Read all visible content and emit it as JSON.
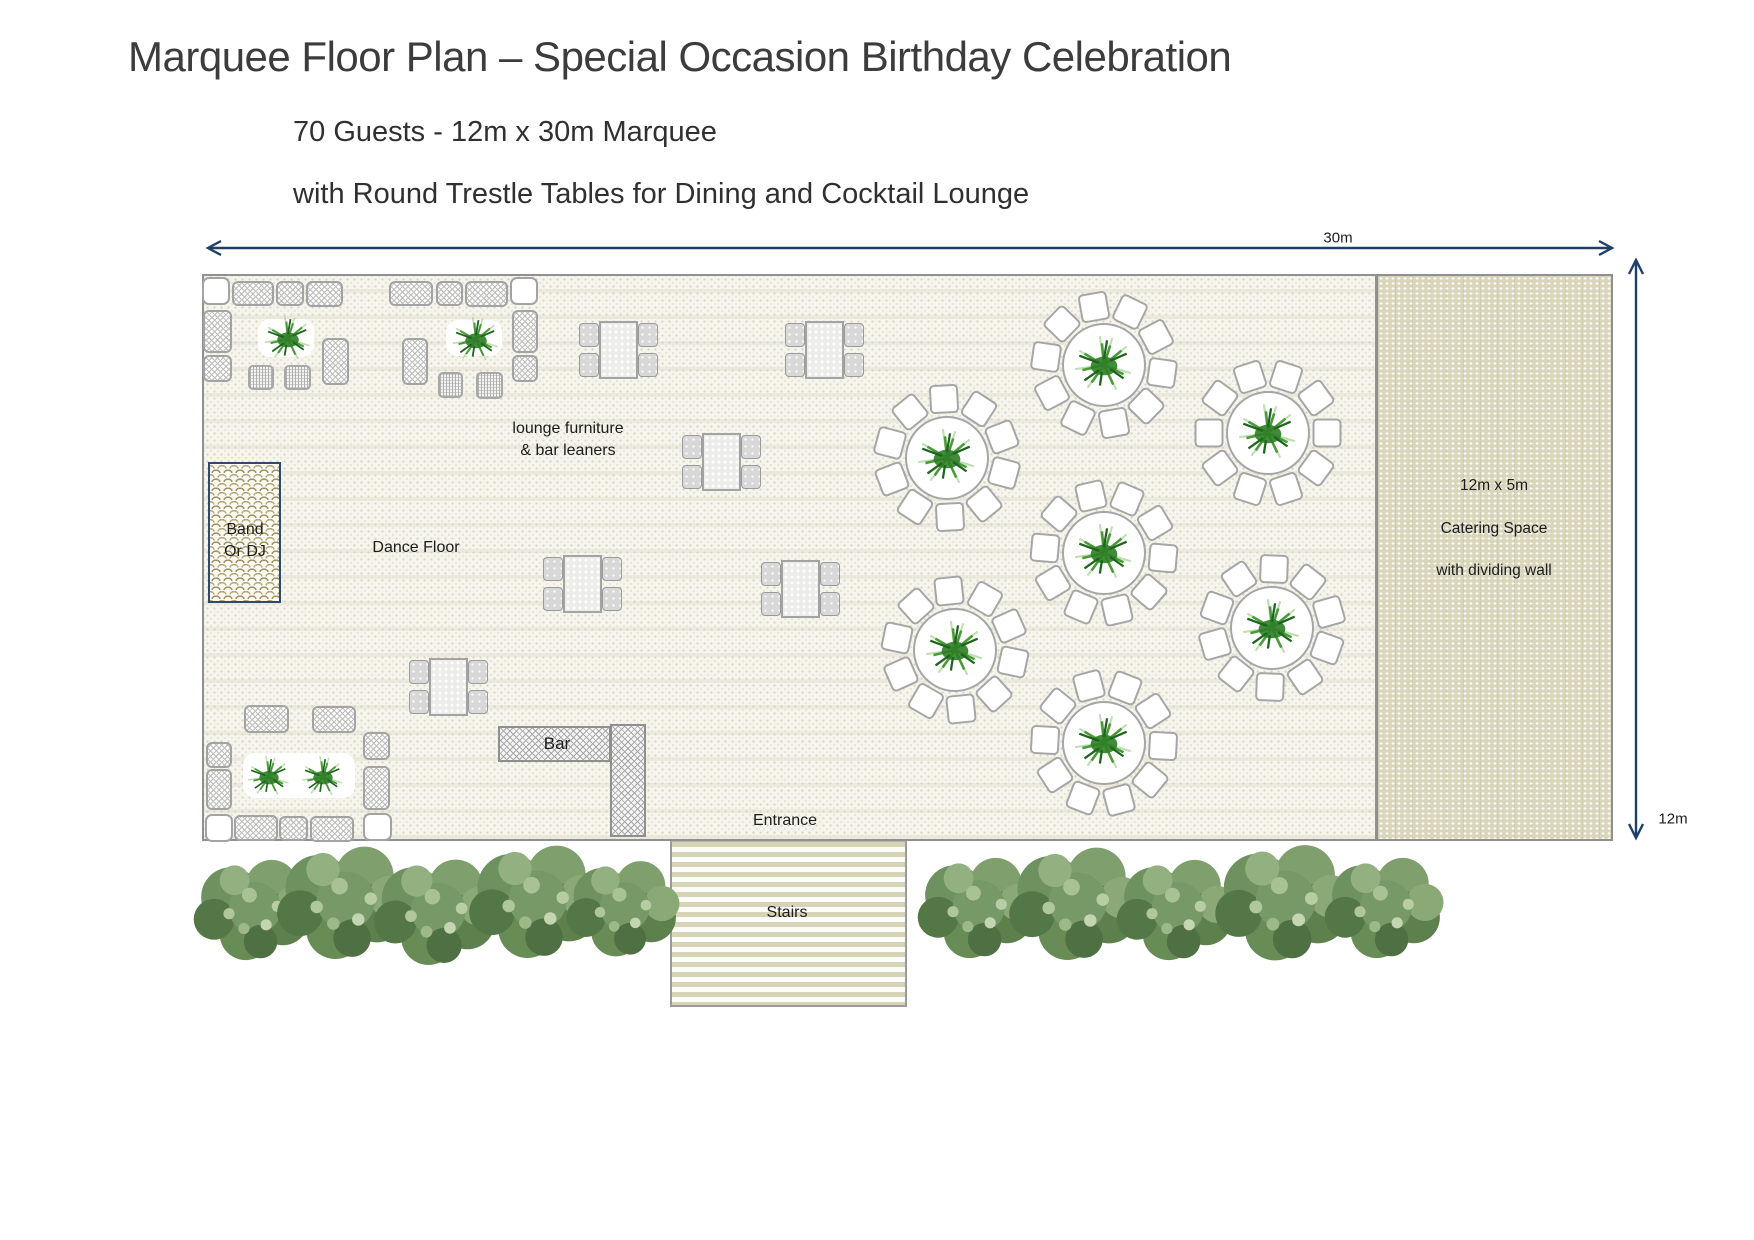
{
  "title": "Marquee Floor Plan – Special Occasion Birthday Celebration",
  "subtitle_line1": "70 Guests  - 12m x 30m Marquee",
  "subtitle_line2": "with Round Trestle Tables for Dining and Cocktail Lounge",
  "dimensions": {
    "width_label": "30m",
    "height_label": "12m"
  },
  "areas": {
    "band": {
      "line1": "Band",
      "line2": "Or DJ"
    },
    "dance_floor": "Dance Floor",
    "lounge": {
      "line1": "lounge  furniture",
      "line2": "& bar leaners"
    },
    "bar": "Bar",
    "entrance": "Entrance",
    "stairs": "Stairs",
    "catering": {
      "line1": "12m x 5m",
      "line2": "Catering Space",
      "line3": "with dividing wall"
    }
  },
  "colors": {
    "arrow": "#1f3f66",
    "band_border": "#33496b",
    "marquee_border": "#909090",
    "floor_base": "#f6f5ed",
    "floor_dot": "#d7d3bd",
    "catering_base": "#dad6bb",
    "stairs_stripe": "#d7d3b7",
    "plant_green": "#2d7e26",
    "tree_green": "#6e9160"
  },
  "floorplan": {
    "marquee": {
      "x": 202,
      "y": 274,
      "w": 1411,
      "h": 567
    },
    "dividing_wall_x": 1376,
    "band_box": {
      "x": 208,
      "y": 462,
      "w": 73,
      "h": 141
    },
    "bar": {
      "horizontal": {
        "x": 498,
        "y": 726,
        "w": 113,
        "h": 36
      },
      "vertical": {
        "x": 610,
        "y": 724,
        "w": 36,
        "h": 113
      }
    },
    "stairs_box": {
      "x": 670,
      "y": 841,
      "w": 237,
      "h": 166
    },
    "round_tables": [
      {
        "x": 1104,
        "y": 365,
        "a": 8
      },
      {
        "x": 947,
        "y": 458,
        "a": 15
      },
      {
        "x": 1268,
        "y": 433,
        "a": 0
      },
      {
        "x": 1104,
        "y": 553,
        "a": 5
      },
      {
        "x": 955,
        "y": 650,
        "a": 12
      },
      {
        "x": 1272,
        "y": 628,
        "a": 20
      },
      {
        "x": 1104,
        "y": 743,
        "a": 3
      }
    ],
    "chairs_per_table": 10,
    "bar_leaner_sets": [
      {
        "x": 618,
        "y": 350
      },
      {
        "x": 824,
        "y": 350
      },
      {
        "x": 721,
        "y": 462
      },
      {
        "x": 582,
        "y": 584
      },
      {
        "x": 800,
        "y": 589
      },
      {
        "x": 448,
        "y": 687
      }
    ],
    "lounge_modules": [
      {
        "x": 202,
        "y": 277,
        "w": 28,
        "h": 28,
        "t": "corner"
      },
      {
        "x": 232,
        "y": 281,
        "w": 42,
        "h": 25,
        "t": "sofa"
      },
      {
        "x": 276,
        "y": 281,
        "w": 28,
        "h": 25,
        "t": "sofa"
      },
      {
        "x": 306,
        "y": 281,
        "w": 37,
        "h": 26,
        "t": "sofa"
      },
      {
        "x": 203,
        "y": 310,
        "w": 29,
        "h": 43,
        "t": "sofa"
      },
      {
        "x": 203,
        "y": 355,
        "w": 29,
        "h": 27,
        "t": "sofa"
      },
      {
        "x": 258,
        "y": 319,
        "w": 56,
        "h": 38,
        "t": "plantbg"
      },
      {
        "x": 248,
        "y": 365,
        "w": 26,
        "h": 25,
        "t": "table"
      },
      {
        "x": 284,
        "y": 365,
        "w": 27,
        "h": 25,
        "t": "table"
      },
      {
        "x": 322,
        "y": 338,
        "w": 27,
        "h": 47,
        "t": "sofa"
      },
      {
        "x": 389,
        "y": 281,
        "w": 44,
        "h": 25,
        "t": "sofa"
      },
      {
        "x": 436,
        "y": 281,
        "w": 27,
        "h": 25,
        "t": "sofa"
      },
      {
        "x": 465,
        "y": 281,
        "w": 43,
        "h": 26,
        "t": "sofa"
      },
      {
        "x": 510,
        "y": 277,
        "w": 28,
        "h": 28,
        "t": "corner"
      },
      {
        "x": 512,
        "y": 310,
        "w": 26,
        "h": 43,
        "t": "sofa"
      },
      {
        "x": 512,
        "y": 355,
        "w": 26,
        "h": 27,
        "t": "sofa"
      },
      {
        "x": 446,
        "y": 320,
        "w": 56,
        "h": 36,
        "t": "plantbg"
      },
      {
        "x": 402,
        "y": 338,
        "w": 26,
        "h": 47,
        "t": "sofa"
      },
      {
        "x": 438,
        "y": 372,
        "w": 25,
        "h": 26,
        "t": "table"
      },
      {
        "x": 476,
        "y": 372,
        "w": 27,
        "h": 27,
        "t": "table"
      },
      {
        "x": 244,
        "y": 705,
        "w": 45,
        "h": 28,
        "t": "sofa"
      },
      {
        "x": 312,
        "y": 706,
        "w": 44,
        "h": 27,
        "t": "sofa"
      },
      {
        "x": 206,
        "y": 742,
        "w": 26,
        "h": 26,
        "t": "sofa"
      },
      {
        "x": 206,
        "y": 769,
        "w": 26,
        "h": 41,
        "t": "sofa"
      },
      {
        "x": 205,
        "y": 814,
        "w": 28,
        "h": 28,
        "t": "corner"
      },
      {
        "x": 234,
        "y": 815,
        "w": 44,
        "h": 26,
        "t": "sofa"
      },
      {
        "x": 279,
        "y": 816,
        "w": 29,
        "h": 25,
        "t": "sofa"
      },
      {
        "x": 310,
        "y": 816,
        "w": 44,
        "h": 26,
        "t": "sofa"
      },
      {
        "x": 363,
        "y": 813,
        "w": 29,
        "h": 28,
        "t": "corner"
      },
      {
        "x": 363,
        "y": 732,
        "w": 27,
        "h": 28,
        "t": "sofa"
      },
      {
        "x": 363,
        "y": 766,
        "w": 27,
        "h": 44,
        "t": "sofa"
      },
      {
        "x": 243,
        "y": 753,
        "w": 112,
        "h": 45,
        "t": "plantbg"
      }
    ],
    "plants": [
      {
        "x": 288,
        "y": 339,
        "s": 58
      },
      {
        "x": 476,
        "y": 340,
        "s": 58
      },
      {
        "x": 269,
        "y": 777,
        "s": 52
      },
      {
        "x": 323,
        "y": 777,
        "s": 52
      }
    ],
    "trees": [
      {
        "x": 255,
        "y": 910,
        "s": 1.0
      },
      {
        "x": 346,
        "y": 903,
        "s": 1.12
      },
      {
        "x": 438,
        "y": 912,
        "s": 1.05
      },
      {
        "x": 538,
        "y": 902,
        "s": 1.12
      },
      {
        "x": 625,
        "y": 909,
        "s": 0.95
      },
      {
        "x": 979,
        "y": 908,
        "s": 1.0
      },
      {
        "x": 1078,
        "y": 904,
        "s": 1.12
      },
      {
        "x": 1178,
        "y": 910,
        "s": 1.0
      },
      {
        "x": 1286,
        "y": 903,
        "s": 1.15
      },
      {
        "x": 1386,
        "y": 908,
        "s": 1.0
      }
    ]
  }
}
